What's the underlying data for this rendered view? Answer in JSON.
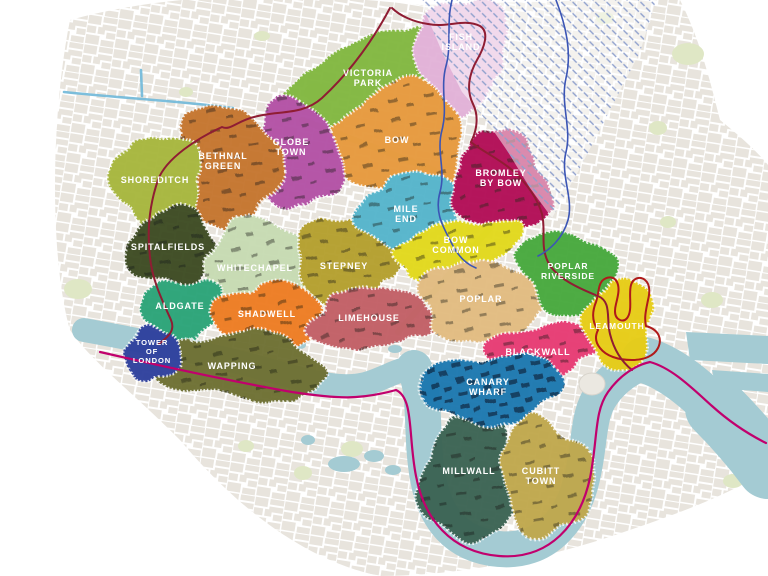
{
  "map": {
    "name": "East London districts map",
    "colors": {
      "background": "#ffffff",
      "water": "#a4cbd3",
      "street_block": "#e5e1d9",
      "park": "#dfe7c5",
      "green_corridor": "#cbe09e",
      "hatch_line": "#8fa0cc",
      "boundary_west": "#8f1d33",
      "boundary_river": "#c1006d",
      "boundary_lea": "#3b55b5",
      "canal": "#6fb8d9",
      "leamouth_inner": "#a2a630",
      "leamouth_outline": "#b01a1a",
      "landmark": "#ebe8e1",
      "label_text": "#ffffff"
    },
    "districts": [
      {
        "id": "victoria-park",
        "label_lines": [
          "VICTORIA",
          "PARK"
        ],
        "color": "#82b840",
        "label_x": 368,
        "label_y": 76,
        "shape": {
          "cx": 374,
          "cy": 72,
          "rx": 100,
          "ry": 35,
          "rot": -24
        }
      },
      {
        "id": "fish-island",
        "label_lines": [
          "FISH",
          "ISLAND"
        ],
        "color": "#e2b2d8",
        "label_x": 461,
        "label_y": 40,
        "shape": {
          "cx": 462,
          "cy": 52,
          "rx": 47,
          "ry": 55,
          "rot": 0
        }
      },
      {
        "id": "bow",
        "label_lines": [
          "BOW"
        ],
        "color": "#e79a3c",
        "label_x": 397,
        "label_y": 143,
        "texture": "sparse",
        "shape": {
          "cx": 400,
          "cy": 139,
          "rx": 69,
          "ry": 53,
          "rot": -8
        }
      },
      {
        "id": "globe-town",
        "label_lines": [
          "GLOBE",
          "TOWN"
        ],
        "color": "#b351a5",
        "label_x": 291,
        "label_y": 145,
        "texture": "sparse",
        "shape": {
          "cx": 296,
          "cy": 156,
          "rx": 46,
          "ry": 53,
          "rot": 0
        }
      },
      {
        "id": "bethnal-green",
        "label_lines": [
          "BETHNAL",
          "GREEN"
        ],
        "color": "#c5752f",
        "label_x": 223,
        "label_y": 159,
        "texture": "sparse",
        "shape": {
          "cx": 228,
          "cy": 166,
          "rx": 50,
          "ry": 62,
          "rot": 6
        }
      },
      {
        "id": "shoreditch",
        "label_lines": [
          "SHOREDITCH"
        ],
        "color": "#a7b73e",
        "label_x": 155,
        "label_y": 183,
        "shape": {
          "cx": 158,
          "cy": 181,
          "rx": 43,
          "ry": 49,
          "rot": 0
        }
      },
      {
        "id": "spitalfields",
        "label_lines": [
          "SPITALFIELDS"
        ],
        "color": "#3c4c24",
        "label_x": 168,
        "label_y": 250,
        "texture": "sparse",
        "shape": {
          "cx": 172,
          "cy": 247,
          "rx": 43,
          "ry": 39,
          "rot": 0
        }
      },
      {
        "id": "whitechapel",
        "label_lines": [
          "WHITECHAPEL"
        ],
        "color": "#c7dbb3",
        "label_x": 255,
        "label_y": 271,
        "texture": "sparse",
        "shape": {
          "cx": 258,
          "cy": 266,
          "rx": 56,
          "ry": 46,
          "rot": 0
        }
      },
      {
        "id": "stepney",
        "label_lines": [
          "STEPNEY"
        ],
        "color": "#b5a02f",
        "label_x": 344,
        "label_y": 269,
        "texture": "sparse",
        "shape": {
          "cx": 347,
          "cy": 262,
          "rx": 53,
          "ry": 46,
          "rot": 0
        }
      },
      {
        "id": "mile-end",
        "label_lines": [
          "MILE",
          "END"
        ],
        "color": "#54b5cc",
        "label_x": 406,
        "label_y": 212,
        "texture": "sparse",
        "shape": {
          "cx": 411,
          "cy": 213,
          "rx": 53,
          "ry": 39,
          "rot": -12
        }
      },
      {
        "id": "bromley-by-bow",
        "label_lines": [
          "BROMLEY",
          "BY BOW"
        ],
        "color": "#b21156",
        "label_x": 501,
        "label_y": 176,
        "texture": "sparse",
        "shape": {
          "cx": 501,
          "cy": 184,
          "rx": 47,
          "ry": 53,
          "rot": 0
        }
      },
      {
        "id": "bow-common",
        "label_lines": [
          "BOW",
          "COMMON"
        ],
        "color": "#e2d91f",
        "label_x": 456,
        "label_y": 243,
        "texture": "sparse",
        "shape": {
          "cx": 456,
          "cy": 248,
          "rx": 63,
          "ry": 27,
          "rot": -14
        }
      },
      {
        "id": "aldgate",
        "label_lines": [
          "ALDGATE"
        ],
        "color": "#2ca478",
        "label_x": 180,
        "label_y": 309,
        "shape": {
          "cx": 183,
          "cy": 308,
          "rx": 41,
          "ry": 31,
          "rot": 0
        }
      },
      {
        "id": "shadwell",
        "label_lines": [
          "SHADWELL"
        ],
        "color": "#ee7b20",
        "label_x": 267,
        "label_y": 317,
        "texture": "sparse",
        "shape": {
          "cx": 269,
          "cy": 315,
          "rx": 56,
          "ry": 31,
          "rot": 4
        }
      },
      {
        "id": "limehouse",
        "label_lines": [
          "LIMEHOUSE"
        ],
        "color": "#c25f66",
        "label_x": 369,
        "label_y": 321,
        "texture": "sparse",
        "shape": {
          "cx": 373,
          "cy": 319,
          "rx": 66,
          "ry": 29,
          "rot": -4
        }
      },
      {
        "id": "poplar",
        "label_lines": [
          "POPLAR"
        ],
        "color": "#e2bc81",
        "label_x": 481,
        "label_y": 302,
        "texture": "sparse",
        "shape": {
          "cx": 483,
          "cy": 301,
          "rx": 67,
          "ry": 39,
          "rot": -4
        }
      },
      {
        "id": "poplar-riverside",
        "label_lines": [
          "POPLAR",
          "RIVERSIDE"
        ],
        "color": "#47a93c",
        "label_x": 568,
        "label_y": 269,
        "font_size": 8.5,
        "shape": {
          "cx": 568,
          "cy": 273,
          "rx": 49,
          "ry": 41,
          "rot": 18
        }
      },
      {
        "id": "wapping",
        "label_lines": [
          "WAPPING"
        ],
        "color": "#6e7031",
        "label_x": 232,
        "label_y": 369,
        "texture": "sparse",
        "shape": {
          "cx": 241,
          "cy": 367,
          "rx": 83,
          "ry": 35,
          "rot": 2
        }
      },
      {
        "id": "tower-of-london",
        "label_lines": [
          "TOWER",
          "OF",
          "LONDON"
        ],
        "color": "#2f3f9d",
        "label_x": 152,
        "label_y": 345,
        "font_size": 7.6,
        "shape": {
          "cx": 153,
          "cy": 354,
          "rx": 27,
          "ry": 28,
          "rot": 0
        }
      },
      {
        "id": "blackwall",
        "label_lines": [
          "BLACKWALL"
        ],
        "color": "#e73a73",
        "label_x": 538,
        "label_y": 355,
        "texture": "sparse",
        "shape": {
          "cx": 541,
          "cy": 352,
          "rx": 61,
          "ry": 27,
          "rot": -8
        }
      },
      {
        "id": "leamouth",
        "label_lines": [
          "LEAMOUTH"
        ],
        "color": "#e7cd18",
        "label_x": 617,
        "label_y": 329,
        "font_size": 8.5,
        "shape": {
          "cx": 619,
          "cy": 324,
          "rx": 35,
          "ry": 44,
          "rot": 0
        }
      },
      {
        "id": "millwall",
        "label_lines": [
          "MILLWALL"
        ],
        "color": "#3a6352",
        "label_x": 469,
        "label_y": 474,
        "texture": "sparse",
        "shape": {
          "cx": 469,
          "cy": 478,
          "rx": 49,
          "ry": 63,
          "rot": 8
        }
      },
      {
        "id": "cubitt-town",
        "label_lines": [
          "CUBITT",
          "TOWN"
        ],
        "color": "#c0a84d",
        "label_x": 541,
        "label_y": 474,
        "texture": "sparse",
        "shape": {
          "cx": 546,
          "cy": 477,
          "rx": 46,
          "ry": 59,
          "rot": -6
        }
      },
      {
        "id": "canary-wharf",
        "label_lines": [
          "CANARY",
          "WHARF"
        ],
        "color": "#1e78b0",
        "label_x": 488,
        "label_y": 385,
        "texture": "dense",
        "shape": {
          "cx": 491,
          "cy": 388,
          "rx": 69,
          "ry": 35,
          "rot": -6
        }
      }
    ]
  }
}
